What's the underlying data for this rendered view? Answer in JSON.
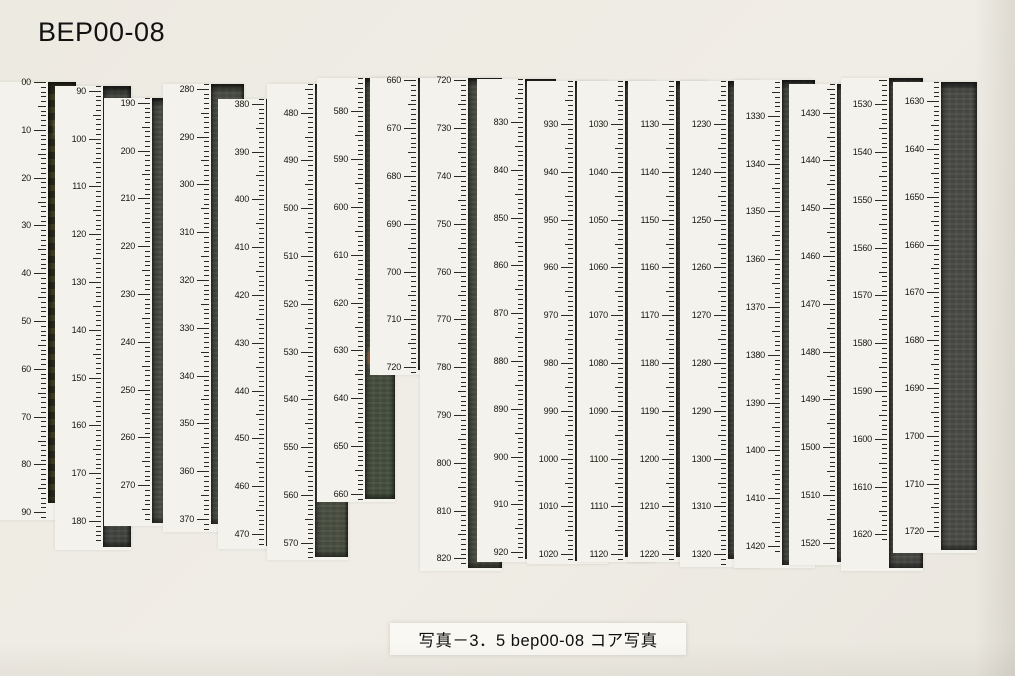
{
  "page": {
    "title": "BEP00-08",
    "caption": "写真－3．5 bep00-08 コア写真",
    "background_color": "#edeae2",
    "panel_color": "#f4f2ec",
    "caption_bg_color": "#faf8f3"
  },
  "ruler": {
    "px_per_cm": 4.78,
    "unit": "cm",
    "tick_color": "#2a2a22",
    "label_color": "#17170f"
  },
  "columns": [
    {
      "section": 1,
      "depth_top_cm": 0,
      "depth_bottom_cm": 88,
      "x": 0,
      "top": 82,
      "tick_start_cm": 0,
      "first_label_cm": 0,
      "tick_end_cm": 91,
      "photo_end_cm": 88,
      "photo_w": 28,
      "photo_color": "#3b3a28",
      "mottled": true,
      "labels": [
        "00",
        "10",
        "20",
        "30",
        "40",
        "50",
        "60",
        "70",
        "80",
        "90"
      ]
    },
    {
      "section": 2,
      "depth_top_cm": 90,
      "depth_bottom_cm": 185,
      "x": 55,
      "top": 86,
      "tick_start_cm": 89,
      "first_label_cm": 90,
      "tick_end_cm": 184,
      "photo_end_cm": 185.5,
      "photo_w": 28,
      "photo_color": "#434540",
      "labels": [
        "90",
        "100",
        "110",
        "120",
        "130",
        "140",
        "150",
        "160",
        "170",
        "180"
      ]
    },
    {
      "section": 3,
      "depth_top_cm": 190,
      "depth_bottom_cm": 278,
      "x": 104,
      "top": 98,
      "tick_start_cm": 189,
      "first_label_cm": 190,
      "tick_end_cm": 277,
      "photo_end_cm": 278,
      "photo_w": 31,
      "photo_color": "#484b41",
      "labels": [
        "190",
        "200",
        "210",
        "220",
        "230",
        "240",
        "250",
        "260",
        "270"
      ]
    },
    {
      "section": 4,
      "depth_top_cm": 280,
      "depth_bottom_cm": 371,
      "x": 163,
      "top": 84,
      "tick_start_cm": 279,
      "first_label_cm": 280,
      "tick_end_cm": 372,
      "photo_end_cm": 371,
      "photo_w": 33,
      "photo_color": "#4b4e45",
      "labels": [
        "280",
        "290",
        "300",
        "310",
        "320",
        "330",
        "340",
        "350",
        "360",
        "370"
      ]
    },
    {
      "section": 5,
      "depth_top_cm": 380,
      "depth_bottom_cm": 472,
      "x": 218,
      "top": 99,
      "tick_start_cm": 379,
      "first_label_cm": 380,
      "tick_end_cm": 472,
      "photo_end_cm": 472.5,
      "photo_w": 30,
      "photo_color": "#4c5143",
      "labels": [
        "380",
        "390",
        "400",
        "410",
        "420",
        "430",
        "440",
        "450",
        "460",
        "470"
      ]
    },
    {
      "section": 6,
      "depth_top_cm": 480,
      "depth_bottom_cm": 573,
      "x": 267,
      "top": 84,
      "tick_start_cm": 474,
      "first_label_cm": 480,
      "tick_end_cm": 573,
      "photo_end_cm": 573,
      "photo_w": 33,
      "photo_color": "#4a5042",
      "specks_cm": [
        511
      ],
      "labels": [
        "480",
        "490",
        "500",
        "510",
        "520",
        "530",
        "540",
        "550",
        "560",
        "570"
      ]
    },
    {
      "section": 7,
      "depth_top_cm": 580,
      "depth_bottom_cm": 661,
      "x": 317,
      "top": 78,
      "tick_start_cm": 573,
      "first_label_cm": 580,
      "tick_end_cm": 661,
      "photo_end_cm": 661,
      "photo_w": 30,
      "photo_color": "#46503f",
      "ring_cm": 631,
      "labels": [
        "580",
        "590",
        "600",
        "610",
        "620",
        "630",
        "640",
        "650",
        "660"
      ]
    },
    {
      "section": 8,
      "depth_top_cm": 660,
      "depth_bottom_cm": 720,
      "x": 370,
      "top": 78,
      "tick_start_cm": 659.5,
      "first_label_cm": 660,
      "tick_end_cm": 721,
      "photo_end_cm": 720.5,
      "photo_w": 27,
      "photo_color": "#475044",
      "labels": [
        "660",
        "670",
        "680",
        "690",
        "700",
        "710",
        "720"
      ]
    },
    {
      "section": 9,
      "depth_top_cm": 720,
      "depth_bottom_cm": 822,
      "x": 420,
      "top": 78,
      "tick_start_cm": 719.5,
      "first_label_cm": 720,
      "tick_end_cm": 821,
      "photo_end_cm": 822,
      "photo_w": 34,
      "photo_color": "#4a4e41",
      "labels": [
        "720",
        "730",
        "740",
        "750",
        "760",
        "770",
        "780",
        "790",
        "800",
        "810",
        "820"
      ]
    },
    {
      "section": 10,
      "depth_top_cm": 821,
      "depth_bottom_cm": 921,
      "x": 477,
      "top": 79,
      "tick_start_cm": 821,
      "first_label_cm": 830,
      "tick_end_cm": 921,
      "photo_end_cm": 921.5,
      "photo_w": 31,
      "photo_color": "#474b3f",
      "labels": [
        "830",
        "840",
        "850",
        "860",
        "870",
        "880",
        "890",
        "900",
        "910",
        "920"
      ]
    },
    {
      "section": 11,
      "depth_top_cm": 921,
      "depth_bottom_cm": 1021,
      "x": 527,
      "top": 81,
      "tick_start_cm": 921,
      "first_label_cm": 930,
      "tick_end_cm": 1021,
      "photo_end_cm": 1021.5,
      "photo_w": 33,
      "photo_color": "#45473c",
      "labels": [
        "930",
        "940",
        "950",
        "960",
        "970",
        "980",
        "990",
        "1000",
        "1010",
        "1020"
      ]
    },
    {
      "section": 12,
      "depth_top_cm": 1021,
      "depth_bottom_cm": 1120,
      "x": 577,
      "top": 81,
      "tick_start_cm": 1021,
      "first_label_cm": 1030,
      "tick_end_cm": 1121,
      "photo_end_cm": 1120.5,
      "photo_w": 30,
      "photo_color": "#45473f",
      "labels": [
        "1030",
        "1040",
        "1050",
        "1060",
        "1070",
        "1080",
        "1090",
        "1100",
        "1110",
        "1120"
      ]
    },
    {
      "section": 13,
      "depth_top_cm": 1121,
      "depth_bottom_cm": 1220,
      "x": 628,
      "top": 81,
      "tick_start_cm": 1121,
      "first_label_cm": 1130,
      "tick_end_cm": 1221,
      "photo_end_cm": 1220.5,
      "photo_w": 32,
      "photo_color": "#434540",
      "labels": [
        "1130",
        "1140",
        "1150",
        "1160",
        "1170",
        "1180",
        "1190",
        "1200",
        "1210",
        "1220"
      ]
    },
    {
      "section": 14,
      "depth_top_cm": 1221,
      "depth_bottom_cm": 1321,
      "x": 680,
      "top": 81,
      "tick_start_cm": 1221,
      "first_label_cm": 1230,
      "tick_end_cm": 1322,
      "photo_end_cm": 1321,
      "photo_w": 32,
      "photo_color": "#444641",
      "labels": [
        "1230",
        "1240",
        "1250",
        "1260",
        "1270",
        "1280",
        "1290",
        "1300",
        "1310",
        "1320"
      ]
    },
    {
      "section": 15,
      "depth_top_cm": 1322.5,
      "depth_bottom_cm": 1424,
      "x": 734,
      "top": 80,
      "tick_start_cm": 1322.5,
      "first_label_cm": 1330,
      "tick_end_cm": 1421,
      "photo_end_cm": 1424,
      "photo_w": 33,
      "photo_color": "#474a43",
      "labels": [
        "1330",
        "1340",
        "1350",
        "1360",
        "1370",
        "1380",
        "1390",
        "1400",
        "1410",
        "1420"
      ]
    },
    {
      "section": 16,
      "depth_top_cm": 1424,
      "depth_bottom_cm": 1524,
      "x": 789,
      "top": 84,
      "tick_start_cm": 1424,
      "first_label_cm": 1430,
      "tick_end_cm": 1521,
      "photo_end_cm": 1524,
      "photo_w": 33,
      "photo_color": "#4b4b46",
      "labels": [
        "1430",
        "1440",
        "1450",
        "1460",
        "1470",
        "1480",
        "1490",
        "1500",
        "1510",
        "1520"
      ]
    },
    {
      "section": 17,
      "depth_top_cm": 1524.5,
      "depth_bottom_cm": 1627,
      "x": 841,
      "top": 78,
      "tick_start_cm": 1524.5,
      "first_label_cm": 1530,
      "tick_end_cm": 1621,
      "photo_end_cm": 1627,
      "photo_w": 34,
      "photo_color": "#484944",
      "labels": [
        "1530",
        "1540",
        "1550",
        "1560",
        "1570",
        "1580",
        "1590",
        "1600",
        "1610",
        "1620"
      ]
    },
    {
      "section": 18,
      "depth_top_cm": 1626,
      "depth_bottom_cm": 1724,
      "x": 893,
      "top": 82,
      "tick_start_cm": 1626,
      "first_label_cm": 1630,
      "tick_end_cm": 1721,
      "photo_end_cm": 1724,
      "photo_w": 36,
      "photo_color": "#4b4c47",
      "labels": [
        "1630",
        "1640",
        "1650",
        "1660",
        "1670",
        "1680",
        "1690",
        "1700",
        "1710",
        "1720"
      ]
    }
  ]
}
